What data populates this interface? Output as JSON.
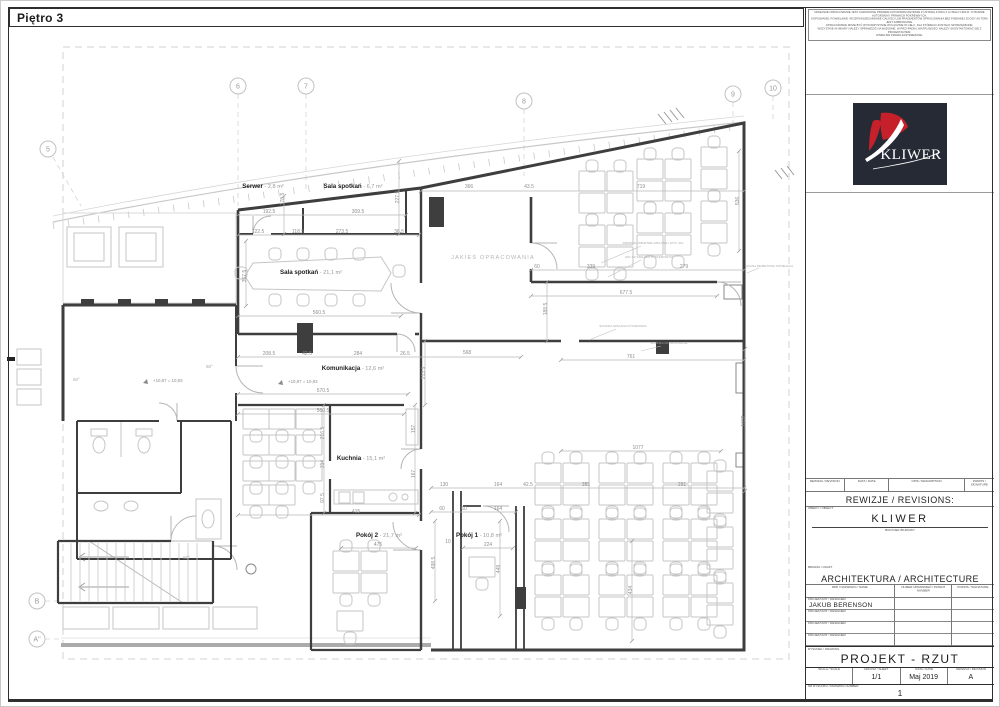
{
  "sheet": {
    "title": "Piętro 3",
    "disclaimer_lines": [
      "NINIEJSZE OPRACOWANIE JEST CHRONIONE PRAWEM AUTORSKIM ZGODNIE Z USTAWĄ Z DNIA 4 LUTEGO 1994 R. O PRAWIE AUTORSKIM I PRAWACH POKREWNYCH.",
      "KOPIOWANIE, POWIELANIE I ROZPOWSZECHNIANIE CAŁOŚCI LUB FRAGMENTÓW OPRACOWANIA BEZ PISEMNEJ ZGODY AUTORA JEST ZABRONIONE.",
      "OPRACOWANIE MOŻE BYĆ WYKORZYSTANE WYŁĄCZNIE W CELU, DLA KTÓREGO ZOSTAŁO SPORZĄDZONE.",
      "WSZYSTKIE WYMIARY NALEŻY SPRAWDZIĆ NA BUDOWIE. W PRZYPADKU WĄTPLIWOŚCI NALEŻY SKONTAKTOWAĆ SIĘ Z PROJEKTANTEM.",
      "WSZELKIE PRAWA ZASTRZEŻONE."
    ]
  },
  "logo": {
    "text": "KLIWER",
    "bg": "#262a34",
    "red": "#c6202b"
  },
  "revisions": {
    "col_headers": [
      "REWIZJA / REVISION",
      "DATA / DATE",
      "OPIS / DESCRIPTION",
      "PODPIS / SIGNATURE"
    ],
    "title": "REWIZJE / REVISIONS:",
    "object_label": "OBIEKT / OBJECT",
    "object_name": "KLIWER",
    "object_sub": "BUDYNEK BIUROWY"
  },
  "craft": {
    "label": "BRANŻA / CRAFT",
    "title": "ARCHITEKTURA / ARCHITECTURE",
    "col_headers": [
      "IMIĘ I NAZWISKO / NAME",
      "NUMER UPRAWNIEŃ / PATENT NUMBER",
      "PODPIS / SIGNATURE"
    ],
    "rows": [
      {
        "role": "PROJEKTANT / DESIGNER",
        "name": "JAKUB BERENSON"
      },
      {
        "role": "PROJEKTANT / DESIGNER",
        "name": ""
      },
      {
        "role": "PROJEKTANT / DESIGNER",
        "name": ""
      },
      {
        "role": "PROJEKTANT / DESIGNER",
        "name": ""
      }
    ]
  },
  "drawing": {
    "label": "RYSUNEK / DRAWING",
    "title": "PROJEKT - RZUT",
    "scale_label": "SKALA / SCALE",
    "scale": "",
    "sheet_label": "ARKUSZ / SHEET",
    "sheet": "1/1",
    "date_label": "DATA / DATE",
    "date": "Maj 2019",
    "rev_label": "REWIZJA / REVISION",
    "rev": "A",
    "number_label": "NR RYSUNKU / DRAWING NUMBER",
    "number": "1"
  },
  "plan": {
    "grid_bubbles": [
      {
        "label": "5",
        "x": 47,
        "y": 148
      },
      {
        "label": "6",
        "x": 237,
        "y": 85
      },
      {
        "label": "7",
        "x": 305,
        "y": 85
      },
      {
        "label": "8",
        "x": 523,
        "y": 100
      },
      {
        "label": "9",
        "x": 732,
        "y": 93
      },
      {
        "label": "10",
        "x": 772,
        "y": 87
      },
      {
        "label": "B",
        "x": 36,
        "y": 600
      },
      {
        "label": "A''",
        "x": 36,
        "y": 638
      }
    ],
    "rooms": [
      {
        "name": "Serwer",
        "area": " - 2,8 m²",
        "x": 262,
        "y": 187
      },
      {
        "name": "Sala spotkań",
        "area": " - 6,7 m²",
        "x": 352,
        "y": 187
      },
      {
        "name": "Sala spotkań",
        "area": " - 21,1 m²",
        "x": 310,
        "y": 273
      },
      {
        "name": "Komunikacja",
        "area": " - 12,6 m²",
        "x": 352,
        "y": 369
      },
      {
        "name": "Kuchnia",
        "area": " - 15,1 m²",
        "x": 360,
        "y": 459
      },
      {
        "name": "Pokój 2",
        "area": " - 21,7 m²",
        "x": 378,
        "y": 536
      },
      {
        "name": "Pokój 1",
        "area": " - 10,8 m²",
        "x": 478,
        "y": 536
      }
    ],
    "levels": [
      {
        "t": "+10,87 = 10,93",
        "x": 152,
        "y": 381
      },
      {
        "t": "+10,87 = 10,93",
        "x": 287,
        "y": 382
      }
    ],
    "angles": [
      {
        "t": "60°",
        "x": 72,
        "y": 380
      },
      {
        "t": "60°",
        "x": 205,
        "y": 367
      },
      {
        "t": "60°",
        "x": 182,
        "y": 558
      }
    ],
    "zone_note": {
      "t": "JAKIEŚ OPRACOWANIA",
      "x": 492,
      "y": 258
    },
    "annotations": [
      {
        "t": "DRZWI ALUMINIOWE SZKLONE / WYS. 210",
        "x": 652,
        "y": 243
      },
      {
        "t": "HPL NA STELAŻU SYSTEMOWYM",
        "x": 648,
        "y": 257
      },
      {
        "t": "ŚCIANKA SZKLANA SYSTEMOWA",
        "x": 622,
        "y": 326
      },
      {
        "t": "ŚCIANKA GK NA RUSZCIE",
        "x": 668,
        "y": 343
      },
      {
        "t": "ŚCIANA ŻELBETOWA ISTNIEJĄCA",
        "x": 768,
        "y": 266
      }
    ],
    "dims": [
      {
        "t": "366",
        "x": 468,
        "y": 187
      },
      {
        "t": "43.5",
        "x": 528,
        "y": 187
      },
      {
        "t": "719",
        "x": 640,
        "y": 187
      },
      {
        "t": "192.5",
        "x": 268,
        "y": 212
      },
      {
        "t": "309.5",
        "x": 357,
        "y": 212
      },
      {
        "t": "122.5",
        "x": 257,
        "y": 232
      },
      {
        "t": "118.5",
        "x": 297,
        "y": 232
      },
      {
        "t": "273.5",
        "x": 341,
        "y": 232
      },
      {
        "t": "36.5",
        "x": 398,
        "y": 232
      },
      {
        "t": "60",
        "x": 536,
        "y": 267
      },
      {
        "t": "339",
        "x": 590,
        "y": 267
      },
      {
        "t": "279",
        "x": 683,
        "y": 267
      },
      {
        "t": "677.5",
        "x": 625,
        "y": 293
      },
      {
        "t": "560.5",
        "x": 318,
        "y": 313
      },
      {
        "t": "208.5",
        "x": 268,
        "y": 354
      },
      {
        "t": "42.5",
        "x": 306,
        "y": 354
      },
      {
        "t": "284",
        "x": 357,
        "y": 354
      },
      {
        "t": "26.5",
        "x": 404,
        "y": 354
      },
      {
        "t": "568",
        "x": 466,
        "y": 353
      },
      {
        "t": "761",
        "x": 630,
        "y": 357
      },
      {
        "t": "570.5",
        "x": 322,
        "y": 391
      },
      {
        "t": "560.5",
        "x": 322,
        "y": 411
      },
      {
        "t": "1077",
        "x": 637,
        "y": 448
      },
      {
        "t": "130",
        "x": 443,
        "y": 485
      },
      {
        "t": "164",
        "x": 497,
        "y": 485
      },
      {
        "t": "42.5",
        "x": 527,
        "y": 485
      },
      {
        "t": "355",
        "x": 585,
        "y": 485
      },
      {
        "t": "291",
        "x": 681,
        "y": 485
      },
      {
        "t": "60",
        "x": 441,
        "y": 509
      },
      {
        "t": "60",
        "x": 463,
        "y": 509
      },
      {
        "t": "164",
        "x": 497,
        "y": 509
      },
      {
        "t": "415",
        "x": 355,
        "y": 512
      },
      {
        "t": "10",
        "x": 447,
        "y": 542
      },
      {
        "t": "475",
        "x": 377,
        "y": 545
      },
      {
        "t": "224",
        "x": 487,
        "y": 545
      },
      {
        "t": "178.5",
        "x": 283,
        "y": 198,
        "r": 1
      },
      {
        "t": "227.5",
        "x": 398,
        "y": 196,
        "r": 1
      },
      {
        "t": "357.5",
        "x": 245,
        "y": 275,
        "r": 1
      },
      {
        "t": "188.5",
        "x": 546,
        "y": 308,
        "r": 1
      },
      {
        "t": "536",
        "x": 738,
        "y": 200,
        "r": 1
      },
      {
        "t": "213.5",
        "x": 424,
        "y": 372,
        "r": 1
      },
      {
        "t": "216.5",
        "x": 323,
        "y": 432,
        "r": 1
      },
      {
        "t": "314",
        "x": 323,
        "y": 463,
        "r": 1
      },
      {
        "t": "97.5",
        "x": 323,
        "y": 497,
        "r": 1
      },
      {
        "t": "157",
        "x": 414,
        "y": 428,
        "r": 1
      },
      {
        "t": "167",
        "x": 414,
        "y": 473,
        "r": 1
      },
      {
        "t": "1032",
        "x": 744,
        "y": 420,
        "r": 1
      },
      {
        "t": "498.5",
        "x": 434,
        "y": 562,
        "r": 1
      },
      {
        "t": "449",
        "x": 499,
        "y": 568,
        "r": 1
      },
      {
        "t": "434",
        "x": 631,
        "y": 589,
        "r": 1
      }
    ]
  }
}
